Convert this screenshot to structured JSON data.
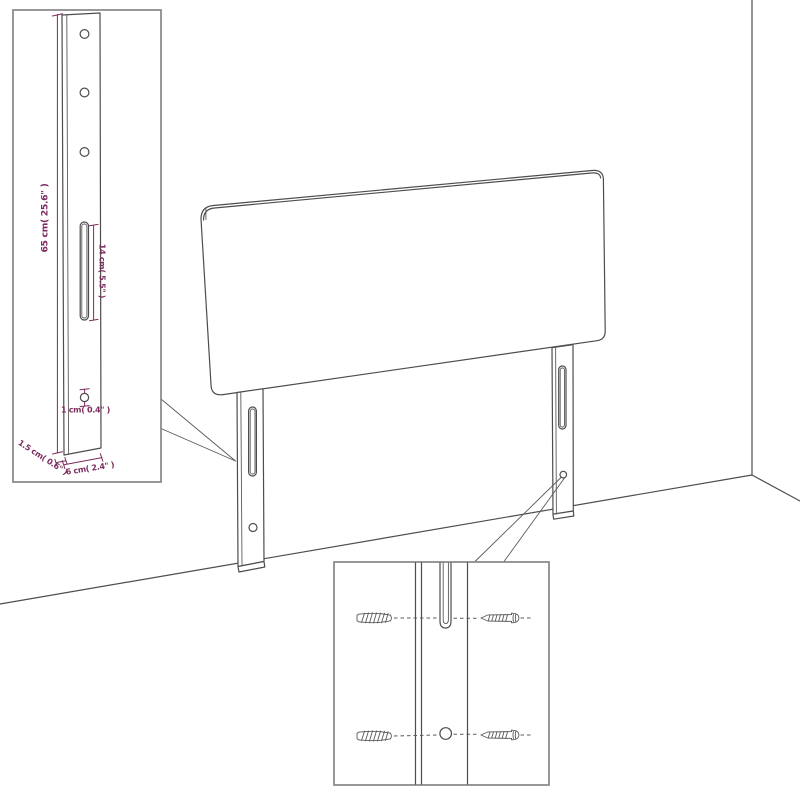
{
  "colors": {
    "background": "#ffffff",
    "outline": "#4d4d4d",
    "dimension_accent": "#7b2b5d",
    "inset_border": "#878787"
  },
  "main_drawing": {
    "subject": "headboard-with-legs-against-wall-corner",
    "icons": [
      "headboard-panel",
      "left-leg",
      "right-leg",
      "mounting-slot",
      "mounting-hole",
      "wall-corner",
      "floor-line"
    ]
  },
  "insets": {
    "leg_detail": {
      "icons": [
        "leg-side-view",
        "screw-hole",
        "mounting-slot",
        "bottom-hole"
      ],
      "dim_height": "65 cm( 25.6\" )",
      "dim_slot": "14 cm( 5.5\" )",
      "dim_hole": "1 cm( 0.4\" )",
      "dim_thickness": "1.5 cm( 0.6\" )",
      "dim_width": "6 cm( 2.4\" )"
    },
    "hardware_detail": {
      "icons": [
        "wall-plug-icon",
        "screw-icon",
        "mounting-slot",
        "mounting-hole"
      ]
    }
  }
}
